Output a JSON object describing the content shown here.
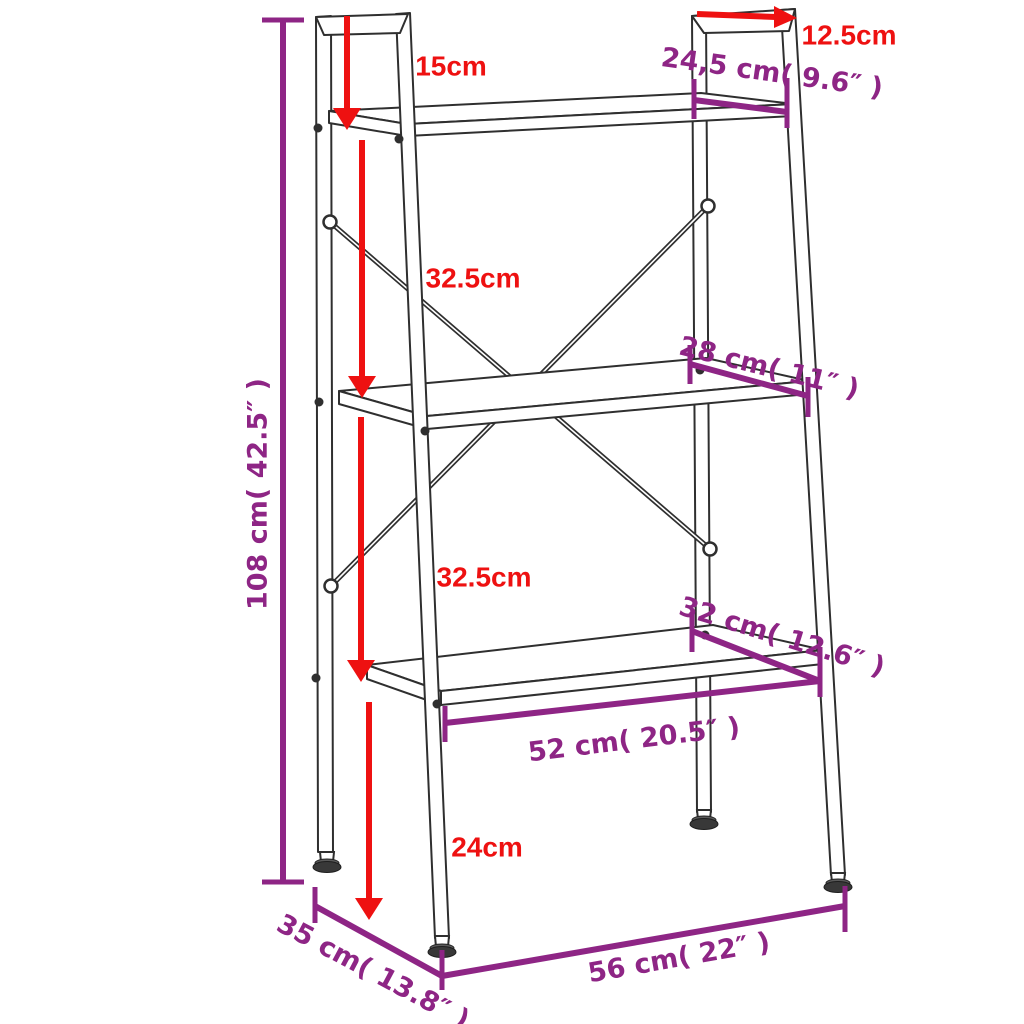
{
  "diagram": {
    "type": "product-dimension-diagram",
    "subject": "3-tier ladder shelf",
    "background": "#ffffff"
  },
  "colors": {
    "arrow_red": "#ee1111",
    "dimension_purple": "#8e2585",
    "outline": "#2f2f2f"
  },
  "dimensions": {
    "top_frame_height": {
      "text": "15cm"
    },
    "top_frame_depth": {
      "text": "12.5cm"
    },
    "top_shelf_depth": {
      "text": "24,5 cm( 9.6″ )"
    },
    "upper_shelf_gap": {
      "text": "32.5cm"
    },
    "lower_shelf_gap": {
      "text": "32.5cm"
    },
    "overall_height": {
      "text": "108 cm( 42.5″ )"
    },
    "middle_shelf_depth": {
      "text": "28 cm( 11″ )"
    },
    "bottom_shelf_depth": {
      "text": "32 cm( 12.6″ )"
    },
    "bottom_shelf_width": {
      "text": "52 cm( 20.5″ )"
    },
    "leg_clearance_height": {
      "text": "24cm"
    },
    "base_depth": {
      "text": "35 cm( 13.8″ )"
    },
    "base_width": {
      "text": "56 cm( 22″ )"
    }
  }
}
